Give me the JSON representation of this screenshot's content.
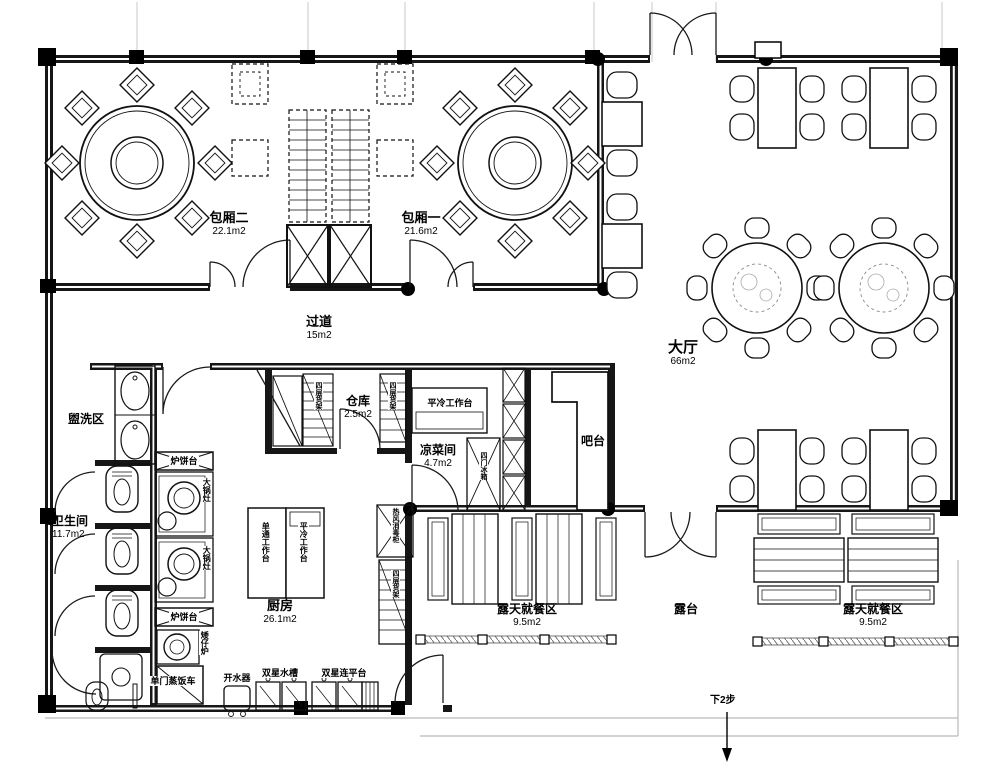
{
  "title": "餐厅平面布置图",
  "rooms": [
    {
      "name": "包厢二",
      "area": "22.1m2"
    },
    {
      "name": "包厢一",
      "area": "21.6m2"
    },
    {
      "name": "过道",
      "area": "15m2"
    },
    {
      "name": "大厅",
      "area": "66m2"
    },
    {
      "name": "盥洗区",
      "area": ""
    },
    {
      "name": "卫生间",
      "area": "11.7m2"
    },
    {
      "name": "仓库",
      "area": "2.5m2"
    },
    {
      "name": "凉菜间",
      "area": "4.7m2"
    },
    {
      "name": "厨房",
      "area": "26.1m2"
    },
    {
      "name": "吧台",
      "area": ""
    },
    {
      "name": "露天就餐区",
      "area": "9.5m2"
    },
    {
      "name": "露台",
      "area": ""
    },
    {
      "name": "露天就餐区",
      "area": "9.5m2"
    }
  ],
  "equipment": {
    "stove_pancake": "炉饼台",
    "stove_bigpot": "大锅灶",
    "stove_low": "矮仔炉",
    "steam_cart": "单门蒸饭车",
    "water_boiler": "开水器",
    "double_sink": "双星水槽",
    "double_sink_platform": "双星连平台",
    "worktable_single": "单通工作台",
    "worktable_cold": "平冷工作台",
    "fridge_4door": "四门冰箱",
    "sterilizer": "热风消毒柜",
    "shelf": "四层货架"
  },
  "annotations": {
    "steps_down": "下2步"
  },
  "colors": {
    "line": "#111111",
    "grid": "#c9c9c9",
    "steps": "#b9b9b9"
  }
}
